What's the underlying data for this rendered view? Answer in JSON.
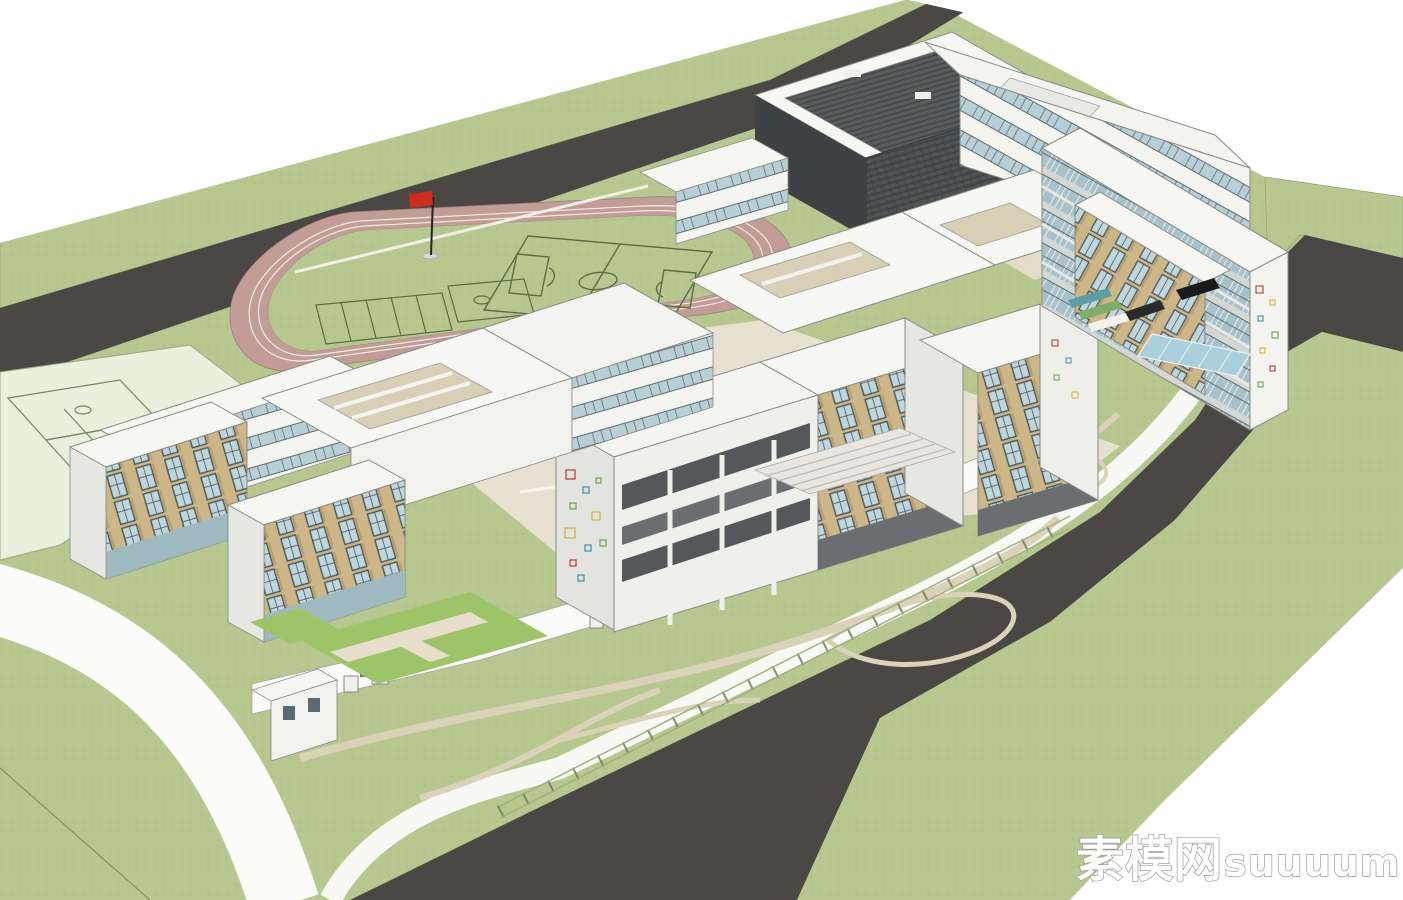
{
  "scene": {
    "description": "3D architectural massing rendering of a school campus",
    "watermark": {
      "cn": "素模网",
      "en": "suuuum.com"
    },
    "palette": {
      "background": "#ffffff",
      "grass": "#b6c890",
      "road": "#4a4745",
      "track": "#c29c97",
      "track_lane_line": "#f1ece4",
      "field_line": "#5c6c44",
      "court_pale": "#e9f0de",
      "building_white": "#fdfdfb",
      "building_shadow": "#dededa",
      "panel_tan": "#cdb687",
      "window_glass": "#bfd6dc",
      "gym_dark": "#4c4f50",
      "path_tan": "#dbd2ba",
      "plaza_tan": "#e7e1d2",
      "canopy_glass": "#aacfdd",
      "fence_green": "#6e7f5a",
      "flag_red": "#cf2b1e",
      "confetti": [
        "#b23b30",
        "#d9b13b",
        "#3f8fa3",
        "#6ba24f"
      ]
    },
    "elements": [
      "running-track",
      "soccer-field",
      "basketball-courts",
      "gymnasium",
      "classroom-buildings",
      "kindergarten-cluster",
      "perimeter-road",
      "perimeter-wall",
      "entrance-canopy",
      "lawn-paths",
      "flag-pole",
      "amphitheater-steps"
    ]
  }
}
